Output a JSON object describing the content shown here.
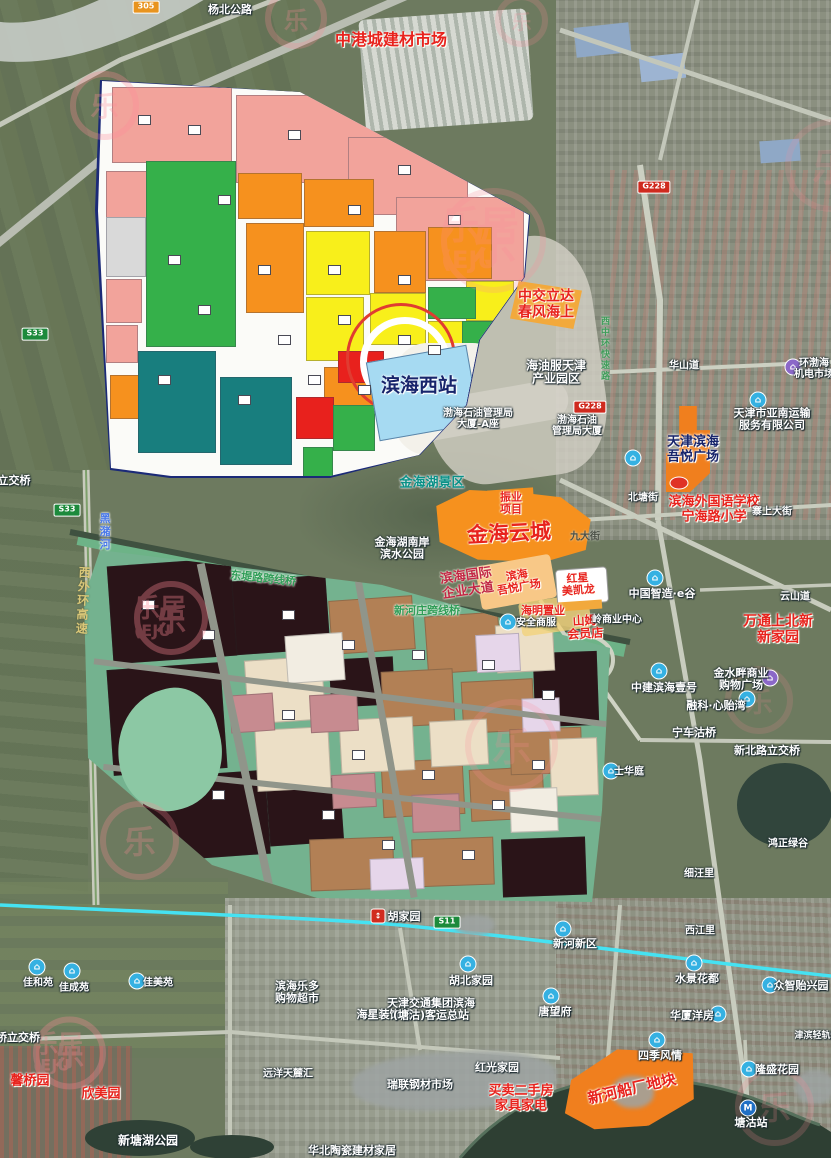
{
  "watermark": {
    "brand": "乐居",
    "glyph": "乐",
    "initials": "(EJU"
  },
  "colors": {
    "metro_line": "#45e2f2",
    "watermark_pink": "#ff8a97",
    "upper_plan_palette": [
      "#f2a39b",
      "#35b04a",
      "#f6911e",
      "#f8ef1b",
      "#e8211d",
      "#187e7e",
      "#a6daf2"
    ],
    "lower_plan_palette": [
      "#2a1418",
      "#b28055",
      "#ecdfc6",
      "#c78b90",
      "#e6d6ea",
      "#79b795"
    ]
  },
  "badges": [
    {
      "name": "badge-305",
      "text": "305",
      "style": "orange",
      "x": 146,
      "y": 7
    },
    {
      "name": "badge-g228-north",
      "text": "G228",
      "style": "red",
      "x": 654,
      "y": 187
    },
    {
      "name": "badge-g228-west",
      "text": "G228",
      "style": "red",
      "x": 590,
      "y": 407
    },
    {
      "name": "badge-s33-north",
      "text": "S33",
      "style": "green",
      "x": 35,
      "y": 334
    },
    {
      "name": "badge-s33-south",
      "text": "S33",
      "style": "green",
      "x": 67,
      "y": 510
    },
    {
      "name": "badge-s11",
      "text": "S11",
      "style": "green",
      "x": 447,
      "y": 922
    }
  ],
  "icons": [
    {
      "name": "poi-icon-egu",
      "type": "blue",
      "x": 655,
      "y": 578
    },
    {
      "name": "poi-icon-zhongjian",
      "type": "blue",
      "x": 659,
      "y": 671
    },
    {
      "name": "poi-icon-jinshuipan",
      "type": "purple",
      "x": 770,
      "y": 678
    },
    {
      "name": "poi-icon-rongke",
      "type": "blue",
      "x": 747,
      "y": 699
    },
    {
      "name": "poi-icon-shihuating",
      "type": "blue",
      "x": 611,
      "y": 771
    },
    {
      "name": "poi-icon-xinhe-new-area",
      "type": "blue",
      "x": 563,
      "y": 929
    },
    {
      "name": "poi-icon-hubei-jiayuan",
      "type": "blue",
      "x": 468,
      "y": 964
    },
    {
      "name": "poi-icon-tangwangfu",
      "type": "blue",
      "x": 551,
      "y": 996
    },
    {
      "name": "poi-icon-shuijing",
      "type": "blue",
      "x": 694,
      "y": 963
    },
    {
      "name": "poi-icon-zhongzhi",
      "type": "blue",
      "x": 770,
      "y": 985
    },
    {
      "name": "poi-icon-huaxia",
      "type": "blue",
      "x": 718,
      "y": 1014
    },
    {
      "name": "poi-icon-siji",
      "type": "blue",
      "x": 657,
      "y": 1040
    },
    {
      "name": "poi-icon-longsheng",
      "type": "blue",
      "x": 749,
      "y": 1069
    },
    {
      "name": "poi-icon-jiaheyuan",
      "type": "blue",
      "x": 37,
      "y": 967
    },
    {
      "name": "poi-icon-jiachengyuan",
      "type": "blue",
      "x": 72,
      "y": 971
    },
    {
      "name": "poi-icon-jiameiyuan",
      "type": "blue",
      "x": 137,
      "y": 981
    },
    {
      "name": "poi-icon-anquan",
      "type": "blue",
      "x": 508,
      "y": 622
    },
    {
      "name": "poi-icon-huanbohai",
      "type": "purple",
      "x": 793,
      "y": 367
    },
    {
      "name": "poi-icon-yanan",
      "type": "blue",
      "x": 758,
      "y": 400
    },
    {
      "name": "poi-icon-haiyang",
      "type": "blue",
      "x": 633,
      "y": 458
    },
    {
      "name": "poi-icon-hujiayuan-rail",
      "type": "rail",
      "x": 378,
      "y": 916
    },
    {
      "name": "poi-icon-tanggu-metro",
      "type": "metro",
      "x": 748,
      "y": 1108
    },
    {
      "name": "poi-icon-school",
      "type": "redoval",
      "x": 679,
      "y": 483
    }
  ],
  "labels": [
    {
      "name": "yangbei-road",
      "text": "杨北公路",
      "style": "place",
      "x": 230,
      "y": 10,
      "size": 11
    },
    {
      "name": "zhonggang-market",
      "text": "中港城建材市场",
      "style": "red",
      "x": 391,
      "y": 40,
      "size": 16
    },
    {
      "name": "zhongjiao-lida",
      "lines": [
        "中交立达",
        "春风海上"
      ],
      "style": "red",
      "x": 546,
      "y": 305,
      "size": 14
    },
    {
      "name": "haiyou-park",
      "lines": [
        "海油服天津",
        "产业园区"
      ],
      "style": "place",
      "x": 556,
      "y": 373,
      "size": 12
    },
    {
      "name": "bohai-bldg-a",
      "lines": [
        "渤海石油管理局",
        "大厦-A座"
      ],
      "style": "place",
      "x": 478,
      "y": 419,
      "size": 10
    },
    {
      "name": "bohai-bldg",
      "lines": [
        "渤海石油",
        "管理局大厦"
      ],
      "style": "place",
      "x": 577,
      "y": 426,
      "size": 10
    },
    {
      "name": "binhai-west-station",
      "text": "滨海西站",
      "style": "navy",
      "x": 419,
      "y": 386,
      "size": 19
    },
    {
      "name": "xizhonghuan-expwy",
      "text": "西中环快速路",
      "style": "vgreen",
      "x": 604,
      "y": 349,
      "size": 9,
      "vert": true
    },
    {
      "name": "yanan-transport",
      "lines": [
        "天津市亚南运输",
        "服务有限公司"
      ],
      "style": "place",
      "x": 772,
      "y": 420,
      "size": 11
    },
    {
      "name": "huanbohai-market",
      "lines": [
        "环渤海",
        "机电市场"
      ],
      "style": "place",
      "x": 814,
      "y": 369,
      "size": 10
    },
    {
      "name": "tianjin-binhai-wuyue",
      "lines": [
        "天津滨海",
        "吾悦广场"
      ],
      "style": "navy",
      "x": 693,
      "y": 450,
      "size": 13
    },
    {
      "name": "huashan-road",
      "text": "华山道",
      "style": "place",
      "x": 684,
      "y": 366,
      "size": 10
    },
    {
      "name": "binhai-foreign-school",
      "lines": [
        "滨海外国语学校",
        "宁海路小学"
      ],
      "style": "red",
      "x": 714,
      "y": 510,
      "size": 13
    },
    {
      "name": "beitang-street",
      "text": "北塘街",
      "style": "place",
      "x": 643,
      "y": 498,
      "size": 10
    },
    {
      "name": "zhaishang-street",
      "text": "寨上大街",
      "style": "place",
      "x": 772,
      "y": 512,
      "size": 10
    },
    {
      "name": "jinhai-lake-scenic",
      "text": "金海湖景区",
      "style": "teal",
      "x": 432,
      "y": 484,
      "size": 13
    },
    {
      "name": "zhenye-project",
      "lines": [
        "振业",
        "项目"
      ],
      "style": "red",
      "x": 511,
      "y": 504,
      "size": 11
    },
    {
      "name": "jinhai-yuncheng",
      "text": "金海云城",
      "style": "red",
      "x": 509,
      "y": 534,
      "size": 21,
      "rot": -3
    },
    {
      "name": "jinhai-south-park",
      "lines": [
        "金海湖南岸",
        "滨水公园"
      ],
      "style": "place",
      "x": 402,
      "y": 549,
      "size": 11
    },
    {
      "name": "binhai-intl-avenue",
      "lines": [
        "滨海国际",
        "企业大道"
      ],
      "style": "crimson",
      "x": 467,
      "y": 584,
      "size": 13,
      "rot": -8
    },
    {
      "name": "binhai-wuyue-plaza",
      "lines": [
        "滨海",
        "吾悦广场"
      ],
      "style": "red",
      "x": 518,
      "y": 582,
      "size": 11,
      "rot": -10
    },
    {
      "name": "redstar-macalline",
      "lines": [
        "红星",
        "美凯龙"
      ],
      "style": "red",
      "x": 578,
      "y": 585,
      "size": 11,
      "rot": -4
    },
    {
      "name": "haiming-zhiye",
      "text": "海明置业",
      "style": "red",
      "x": 543,
      "y": 611,
      "size": 11
    },
    {
      "name": "anquan-shangfu",
      "text": "安全商服",
      "style": "place",
      "x": 536,
      "y": 623,
      "size": 10
    },
    {
      "name": "sams-club",
      "lines": [
        "山姆",
        "会员店"
      ],
      "style": "red",
      "x": 585,
      "y": 628,
      "size": 12,
      "rot": -3
    },
    {
      "name": "ling-commercial-center",
      "text": "岭商业中心",
      "style": "place",
      "x": 617,
      "y": 620,
      "size": 10
    },
    {
      "name": "china-smart-valley",
      "text": "中国智造·e谷",
      "style": "place",
      "x": 662,
      "y": 594,
      "size": 11
    },
    {
      "name": "yunshan-road",
      "text": "云山道",
      "style": "place",
      "x": 795,
      "y": 597,
      "size": 10
    },
    {
      "name": "wantong-new-home",
      "lines": [
        "万通上北新",
        "新家园"
      ],
      "style": "red",
      "x": 778,
      "y": 630,
      "size": 14
    },
    {
      "name": "xinhezhuang-bridge",
      "text": "新河庄跨线桥",
      "style": "green",
      "x": 427,
      "y": 611,
      "size": 11
    },
    {
      "name": "dongdilu-bridge",
      "text": "东堤路跨线桥",
      "style": "green",
      "x": 263,
      "y": 579,
      "size": 11,
      "rot": 6
    },
    {
      "name": "heizhu-river",
      "text": "黑潴河",
      "style": "vblue",
      "x": 104,
      "y": 532,
      "size": 11,
      "vert": true
    },
    {
      "name": "xiwaihuan-expwy",
      "text": "西外环高速",
      "style": "vyellow",
      "x": 82,
      "y": 601,
      "size": 12,
      "vert": true,
      "rot": 3
    },
    {
      "name": "zhongjian-binhai-no1",
      "text": "中建滨海壹号",
      "style": "place",
      "x": 664,
      "y": 688,
      "size": 11
    },
    {
      "name": "jinshuipan-mall",
      "lines": [
        "金水畔商业",
        "购物广场"
      ],
      "style": "place",
      "x": 741,
      "y": 680,
      "size": 11
    },
    {
      "name": "rongke-xinyiwan",
      "text": "融科·心贻湾",
      "style": "place",
      "x": 716,
      "y": 706,
      "size": 11
    },
    {
      "name": "ningchegu-bridge",
      "text": "宁车沽桥",
      "style": "place",
      "x": 694,
      "y": 733,
      "size": 11
    },
    {
      "name": "xinbeilu-interchange",
      "text": "新北路立交桥",
      "style": "place",
      "x": 767,
      "y": 751,
      "size": 11
    },
    {
      "name": "shihuating",
      "text": "士华庭",
      "style": "place",
      "x": 629,
      "y": 772,
      "size": 10
    },
    {
      "name": "xiwangli",
      "text": "细汪里",
      "style": "place",
      "x": 699,
      "y": 874,
      "size": 10
    },
    {
      "name": "hongzheng-lvgu",
      "text": "鸿正绿谷",
      "style": "place",
      "x": 788,
      "y": 844,
      "size": 10
    },
    {
      "name": "xijiangli",
      "text": "西江里",
      "style": "place",
      "x": 700,
      "y": 931,
      "size": 10
    },
    {
      "name": "hujiayuan",
      "text": "胡家园",
      "style": "place",
      "x": 404,
      "y": 917,
      "size": 11
    },
    {
      "name": "xinhe-new-area",
      "text": "新河新区",
      "style": "place",
      "x": 575,
      "y": 944,
      "size": 11
    },
    {
      "name": "hubei-jiayuan",
      "text": "胡北家园",
      "style": "place",
      "x": 471,
      "y": 981,
      "size": 11
    },
    {
      "name": "tangwangfu",
      "text": "唐望府",
      "style": "place",
      "x": 555,
      "y": 1012,
      "size": 11
    },
    {
      "name": "shuijing-huadu",
      "text": "水景花都",
      "style": "place",
      "x": 697,
      "y": 979,
      "size": 11
    },
    {
      "name": "zhongzhi-yixingyuan",
      "text": "众智贻兴园",
      "style": "place",
      "x": 801,
      "y": 986,
      "size": 11
    },
    {
      "name": "huaxia-yangfang",
      "text": "华厦洋房",
      "style": "place",
      "x": 692,
      "y": 1016,
      "size": 11
    },
    {
      "name": "siji-fengqing",
      "text": "四季风情",
      "style": "place",
      "x": 660,
      "y": 1056,
      "size": 11
    },
    {
      "name": "longsheng-garden",
      "text": "隆盛花园",
      "style": "place",
      "x": 777,
      "y": 1070,
      "size": 11
    },
    {
      "name": "tanggu-station",
      "text": "塘沽站",
      "style": "place",
      "x": 751,
      "y": 1123,
      "size": 11
    },
    {
      "name": "jiaheyuan",
      "text": "佳和苑",
      "style": "place",
      "x": 38,
      "y": 983,
      "size": 10
    },
    {
      "name": "jiachengyuan",
      "text": "佳成苑",
      "style": "place",
      "x": 74,
      "y": 988,
      "size": 10
    },
    {
      "name": "jiameiyuan",
      "text": "佳美苑",
      "style": "place",
      "x": 158,
      "y": 983,
      "size": 10
    },
    {
      "name": "qiao-interchange-sw",
      "text": "桥立交桥",
      "style": "place",
      "x": 18,
      "y": 1038,
      "size": 11
    },
    {
      "name": "interchange-west",
      "text": "立交桥",
      "style": "place",
      "x": 14,
      "y": 481,
      "size": 11
    },
    {
      "name": "xinmeiyuan",
      "text": "欣美园",
      "style": "red",
      "x": 101,
      "y": 1095,
      "size": 13
    },
    {
      "name": "xinqiaoyuan",
      "text": "馨桥园",
      "style": "red",
      "x": 30,
      "y": 1082,
      "size": 13
    },
    {
      "name": "binhai-leduo",
      "lines": [
        "滨海乐多",
        "购物超市"
      ],
      "style": "place",
      "x": 297,
      "y": 993,
      "size": 11
    },
    {
      "name": "haixing-decor-city",
      "text": "海星装饰城",
      "style": "place",
      "x": 384,
      "y": 1015,
      "size": 11
    },
    {
      "name": "keyun-terminal",
      "lines": [
        "天津交通集团滨海",
        "(塘沽)客运总站"
      ],
      "style": "place",
      "x": 431,
      "y": 1010,
      "size": 11
    },
    {
      "name": "ruilian-steel-market",
      "text": "瑞联钢材市场",
      "style": "place",
      "x": 420,
      "y": 1085,
      "size": 11
    },
    {
      "name": "hongguang-jiayuan",
      "text": "红光家园",
      "style": "place",
      "x": 497,
      "y": 1068,
      "size": 11
    },
    {
      "name": "secondhand-ad",
      "lines": [
        "买卖二手房",
        "家具家电"
      ],
      "style": "red",
      "x": 521,
      "y": 1099,
      "size": 13
    },
    {
      "name": "xinhe-shipyard-parcel",
      "text": "新河船厂地块",
      "style": "red",
      "x": 632,
      "y": 1089,
      "size": 15,
      "rot": -13
    },
    {
      "name": "yuanyang-tianluhui",
      "text": "远洋天麓汇",
      "style": "place",
      "x": 288,
      "y": 1074,
      "size": 10
    },
    {
      "name": "xintanghu-park",
      "text": "新塘湖公园",
      "style": "place",
      "x": 148,
      "y": 1141,
      "size": 12
    },
    {
      "name": "huabei-taoci",
      "text": "华北陶瓷建材家居",
      "style": "place",
      "x": 352,
      "y": 1151,
      "size": 11
    },
    {
      "name": "jinbin-light-rail",
      "text": "津滨轻轨快速路",
      "style": "place",
      "x": 826,
      "y": 1036,
      "size": 9
    },
    {
      "name": "jiu-street",
      "text": "九大街",
      "style": "dim",
      "x": 585,
      "y": 537,
      "size": 10
    }
  ],
  "watermarks": [
    {
      "name": "wm-1",
      "x": 70,
      "y": 105,
      "size": 92,
      "op": 0.3,
      "side": false
    },
    {
      "name": "wm-2",
      "x": 480,
      "y": 240,
      "size": 150,
      "op": 0.22,
      "side": true
    },
    {
      "name": "wm-3",
      "x": 160,
      "y": 618,
      "size": 100,
      "op": 0.34,
      "side": true
    },
    {
      "name": "wm-4",
      "x": 100,
      "y": 840,
      "size": 108,
      "op": 0.26,
      "side": false
    },
    {
      "name": "wm-5",
      "x": 465,
      "y": 745,
      "size": 130,
      "op": 0.2,
      "side": false
    },
    {
      "name": "wm-6",
      "x": 725,
      "y": 700,
      "size": 90,
      "op": 0.16,
      "side": false
    },
    {
      "name": "wm-7",
      "x": 58,
      "y": 1053,
      "size": 98,
      "op": 0.3,
      "side": true
    },
    {
      "name": "wm-8",
      "x": 735,
      "y": 1106,
      "size": 108,
      "op": 0.2,
      "side": false
    },
    {
      "name": "wm-9",
      "x": 785,
      "y": 165,
      "size": 130,
      "op": 0.16,
      "side": false
    },
    {
      "name": "wm-10",
      "x": 265,
      "y": 18,
      "size": 80,
      "op": 0.26,
      "side": false
    },
    {
      "name": "wm-11",
      "x": 495,
      "y": 20,
      "size": 66,
      "op": 0.2,
      "side": false
    }
  ]
}
